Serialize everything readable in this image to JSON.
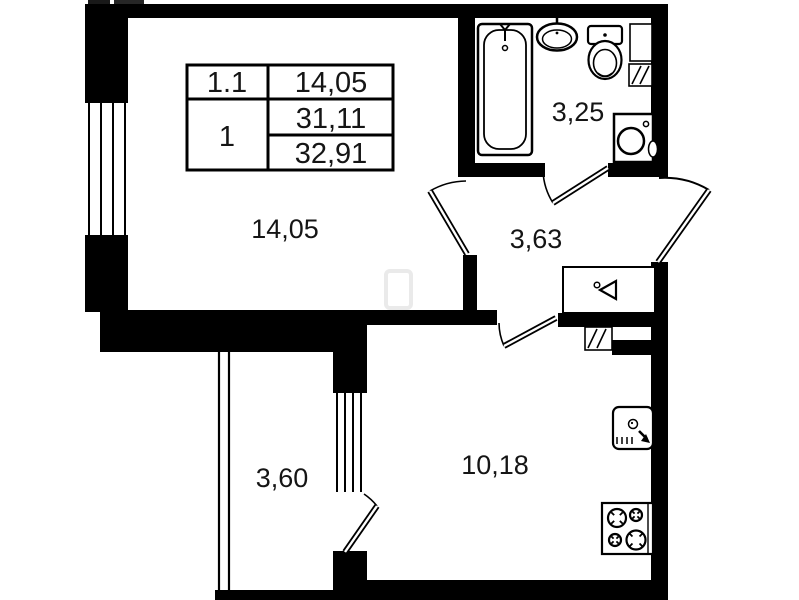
{
  "document": {
    "type": "apartment-floor-plan",
    "background_color": "#ffffff",
    "wall_color": "#000000",
    "text_color": "#151515"
  },
  "legend_table": {
    "rows": [
      {
        "label": "1.1",
        "value": "14,05"
      },
      {
        "label": "1",
        "value_top": "31,11",
        "value_bottom": "32,91"
      }
    ]
  },
  "rooms": [
    {
      "name": "living-room",
      "area_label": "14,05"
    },
    {
      "name": "bathroom",
      "area_label": "3,25"
    },
    {
      "name": "hallway",
      "area_label": "3,63"
    },
    {
      "name": "balcony",
      "area_label": "3,60"
    },
    {
      "name": "kitchen",
      "area_label": "10,18"
    }
  ],
  "fixtures": [
    "bathtub",
    "washbasin",
    "toilet",
    "washing-machine",
    "ventilation-shaft",
    "duct-niche",
    "wardrobe-with-hanger",
    "kitchen-sink",
    "stove-4-burners",
    "entrance-door",
    "interior-door",
    "balcony-door",
    "window",
    "balcony-window"
  ]
}
